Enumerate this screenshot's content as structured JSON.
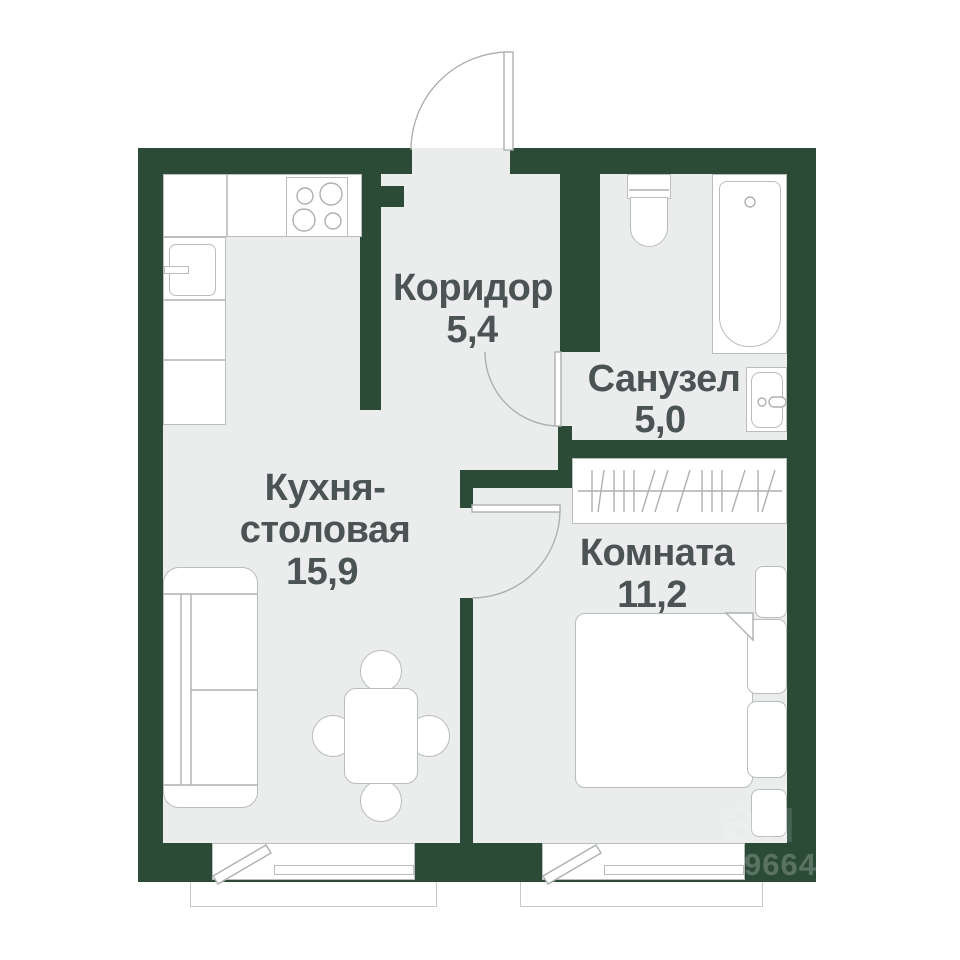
{
  "plan": {
    "colors": {
      "wall": "#2c4b36",
      "floor": "#ebecec",
      "line": "#b9bdbd",
      "ink": "#4b5354"
    },
    "rooms": [
      {
        "name": "Коридор",
        "area": "5,4"
      },
      {
        "name": "Санузел",
        "area": "5,0"
      },
      {
        "name": "Кухня-",
        "name2": "столовая",
        "area": "15,9"
      },
      {
        "name": "Комната",
        "area": "11,2"
      }
    ],
    "watermark": {
      "text": "ан",
      "number": "9664"
    }
  }
}
